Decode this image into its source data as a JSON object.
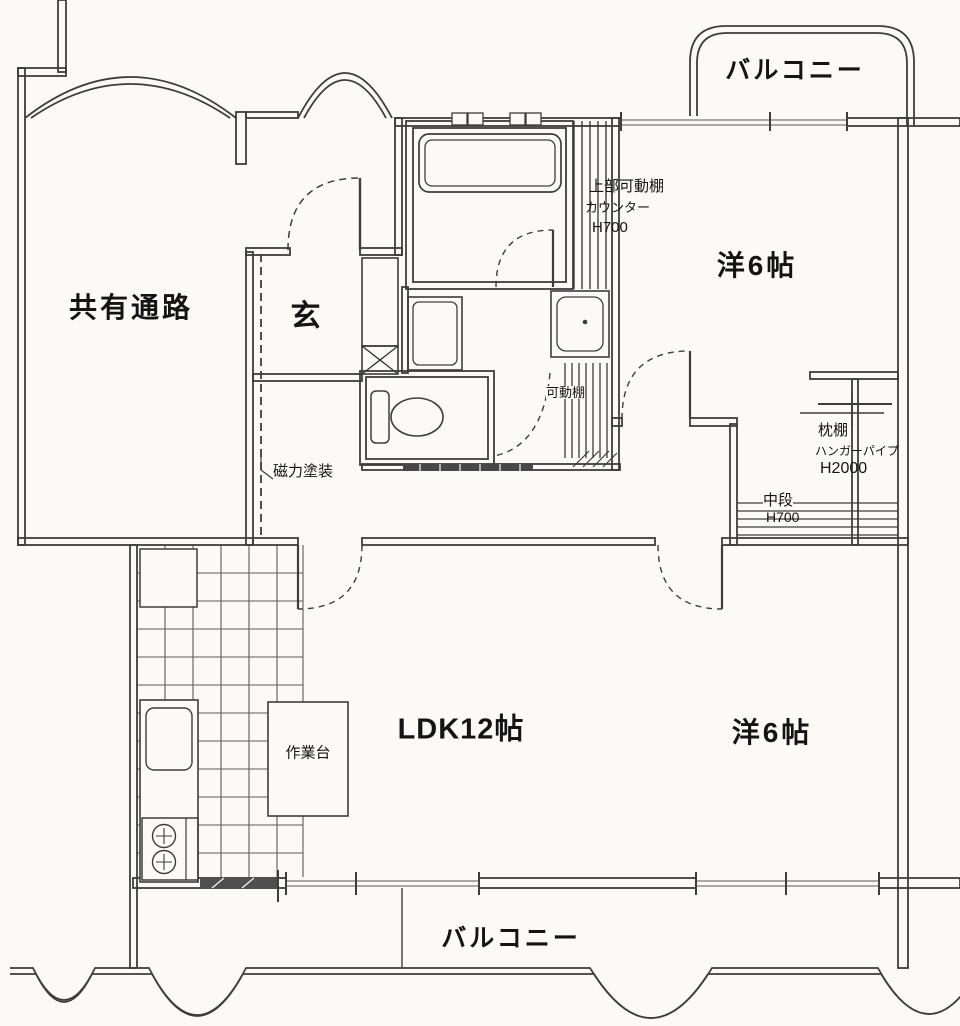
{
  "rooms": {
    "balcony_top": {
      "label": "バルコニー"
    },
    "shared_corridor": {
      "label": "共有通路"
    },
    "entrance": {
      "label": "玄"
    },
    "western_room_top": {
      "label": "洋6帖"
    },
    "ldk": {
      "label": "LDK12帖"
    },
    "western_room_bottom": {
      "label": "洋6帖"
    },
    "balcony_bottom": {
      "label": "バルコニー"
    }
  },
  "annotations": {
    "upper_movable_shelf": {
      "label": "上部可動棚"
    },
    "counter": {
      "label": "カウンター"
    },
    "counter_height": {
      "label": "H700"
    },
    "movable_shelf": {
      "label": "可動棚"
    },
    "magnetic_paint": {
      "label": "磁力塗装"
    },
    "pillow_shelf": {
      "label": "枕棚"
    },
    "hanger_pipe": {
      "label": "ハンガーパイプ"
    },
    "hanger_pipe_height": {
      "label": "H2000"
    },
    "middle_shelf": {
      "label": "中段"
    },
    "middle_shelf_height": {
      "label": "H700"
    },
    "work_table": {
      "label": "作業台"
    }
  },
  "colors": {
    "background": "#fbfaf7",
    "line": "#3d3d3d",
    "window": "#8c8c8c",
    "text": "#141414"
  }
}
